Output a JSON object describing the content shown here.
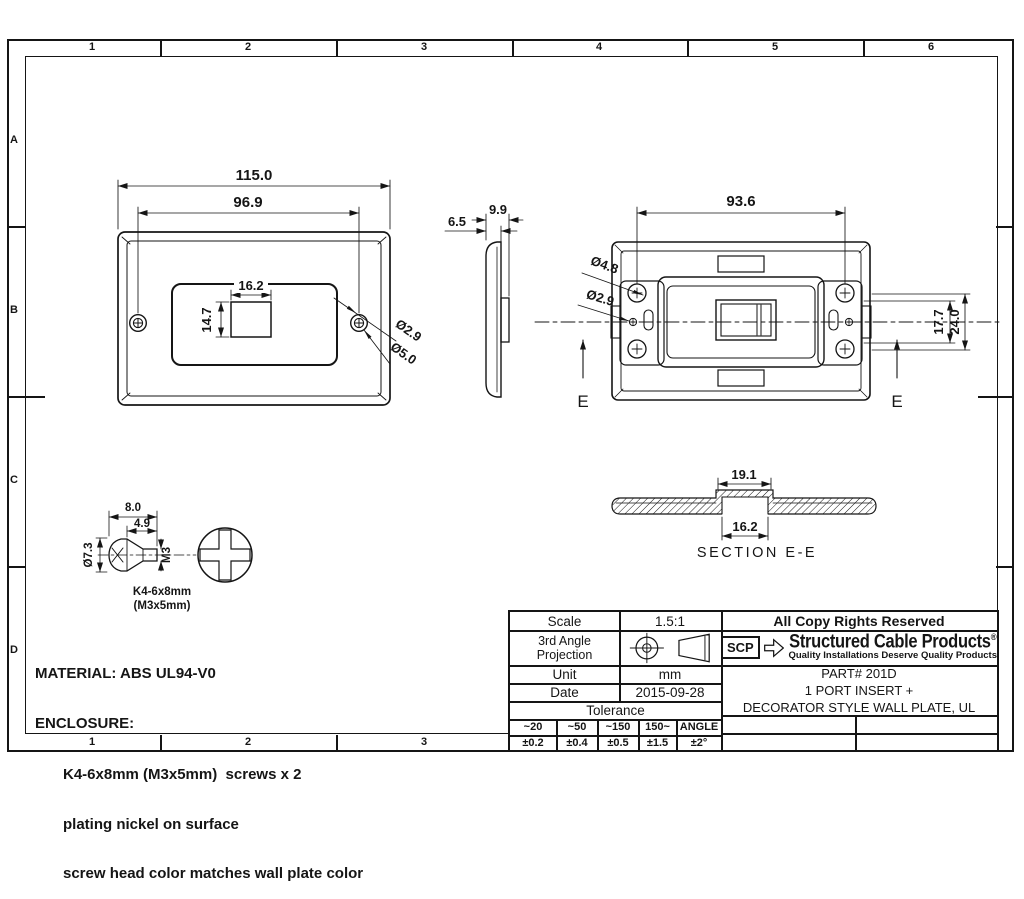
{
  "frame": {
    "top_labels": [
      "1",
      "2",
      "3",
      "4",
      "5",
      "6"
    ],
    "bottom_labels": [
      "1",
      "2",
      "3"
    ],
    "left_labels": [
      "A",
      "B",
      "C",
      "D"
    ]
  },
  "views": {
    "front": {
      "dim_overall_width": "115.0",
      "dim_hole_span": "96.9",
      "dim_opening_width": "16.2",
      "dim_opening_height": "14.7",
      "dim_screw_hole": "Ø2.9",
      "dim_screw_recess": "Ø5.0"
    },
    "side": {
      "dim_depth_body": "6.5",
      "dim_depth_total": "9.9"
    },
    "rear": {
      "dim_boss_span": "93.6",
      "dim_boss_hole": "Ø4.8",
      "dim_screw_hole": "Ø2.9",
      "dim_bracket_inner": "17.7",
      "dim_bracket_outer": "24.0",
      "section_marker": "E"
    },
    "section": {
      "dim_boss_width": "19.1",
      "dim_opening_width": "16.2",
      "caption": "SECTION E-E"
    },
    "screw": {
      "dim_length": "8.0",
      "dim_shaft": "4.9",
      "dim_head": "Ø7.3",
      "dim_thread": "M3",
      "label_line1": "K4-6x8mm",
      "label_line2": "(M3x5mm)"
    }
  },
  "notes": {
    "material": "MATERIAL: ABS UL94-V0",
    "enclosure": "ENCLOSURE:",
    "item1": "K4-6x8mm (M3x5mm)  screws x 2",
    "item2": "plating nickel on surface",
    "item3": "screw head color matches wall plate color"
  },
  "title_block": {
    "scale_label": "Scale",
    "scale_value": "1.5:1",
    "projection_line1": "3rd Angle",
    "projection_line2": "Projection",
    "unit_label": "Unit",
    "unit_value": "mm",
    "date_label": "Date",
    "date_value": "2015-09-28",
    "tolerance_label": "Tolerance",
    "tol_headers": [
      "~20",
      "~50",
      "~150",
      "150~",
      "ANGLE"
    ],
    "tol_values": [
      "±0.2",
      "±0.4",
      "±0.5",
      "±1.5",
      "±2°"
    ],
    "copyright": "All Copy Rights Reserved",
    "logo": "SCP",
    "brand": "Structured Cable Products",
    "registered": "®",
    "tagline": "Quality Installations Deserve Quality Products",
    "part_number": "PART# 201D",
    "part_desc1": "1 PORT INSERT +",
    "part_desc2": "DECORATOR STYLE WALL PLATE, UL"
  },
  "colors": {
    "line": "#151515",
    "background": "#ffffff"
  }
}
